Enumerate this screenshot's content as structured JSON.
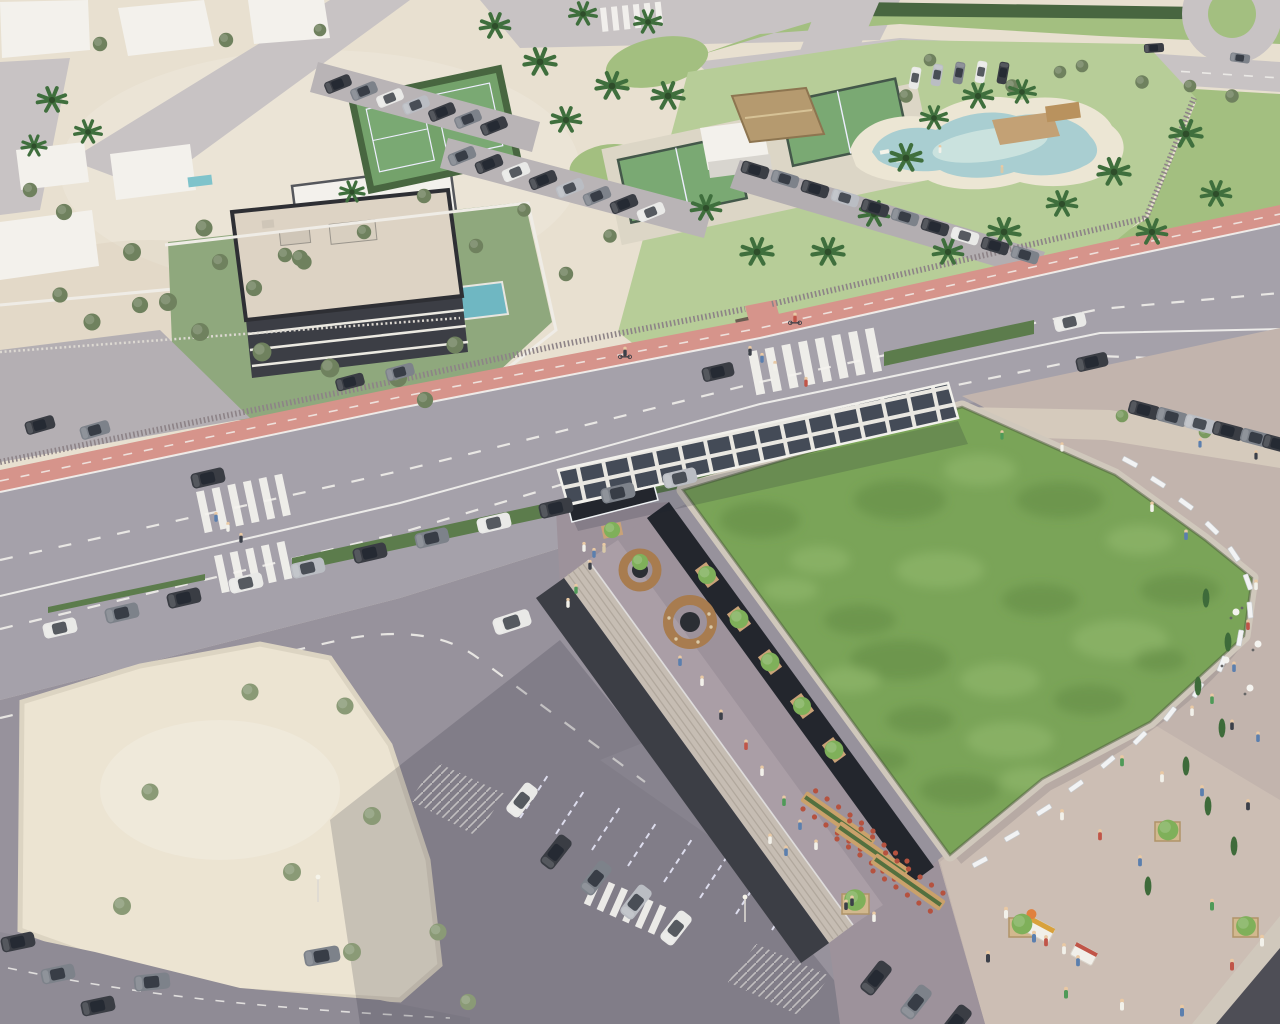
{
  "meta": {
    "title": "Aerial architectural rendering — coastal commercial building with sedum green roof, rooftop promenade, beach club and parking",
    "description": "Sunny high-angle render: a large commercial building with a mottled green roof, photovoltaic entrance canopy, restaurant terrace and curved pedestrian promenade sits beside a wide boulevard with a red bike lane; across the road are a beach club with lagoon pool and padel courts, white villas, a three-storey apartment block, lawns, a roundabout, sandy plaza and car parks."
  },
  "colors": {
    "sand": "#e8e0d0",
    "plaza": "#ece4d2",
    "roadMain": "#a5a1aa",
    "roadMinor": "#c8c3c4",
    "asphalt": "#97929c",
    "redLane": "#d6948b",
    "lineWhite": "#f4f3ef",
    "lawn": "#a3bf80",
    "clubLawn": "#b7cd98",
    "court": "#7aa973",
    "hedge": "#5c7c4c",
    "hedgeDark": "#486640",
    "olive": "#6f815e",
    "treeBright": "#7fb05a",
    "palm": "#3f6f3d",
    "cypress": "#3e6b3a",
    "water": "#a9ced1",
    "waterLight": "#d2e7e1",
    "beach": "#ece6d4",
    "deck": "#c3a175",
    "thatch": "#b59a6f",
    "white": "#f3f1ec",
    "roofSlab": "#ddd3c4",
    "facadeDark": "#3c3e45",
    "glassDark": "#23262d",
    "concrete": "#c9c1b5",
    "parapet": "#d0c8bc",
    "terrace": "#9d929b",
    "terraceLit": "#b4a8ae",
    "stairs": "#c6bdb3",
    "promenade": "#c2b4ad",
    "promenadeLit": "#d6c8bc",
    "greenRoof": "#7aa458",
    "greenRoofDark": "#5f8a42",
    "greenRoofLight": "#94ba6f",
    "solarPanel": "#444b57",
    "solarFrame": "#e9e7e1",
    "wood": "#a87c4f",
    "carDark": "#3a3d44",
    "carGray": "#7d828a",
    "carSilver": "#babdc3",
    "carWhite": "#e9e9e7",
    "chairRed": "#b5523f",
    "shadow": "#232033"
  },
  "scene": {
    "setting": "Sunny coastal resort district, high-angle aerial view, no visible text in image",
    "regions": [
      {
        "name": "beach-club",
        "label": "Beach club with lagoon pool, padel courts, thatched pavilion and palms"
      },
      {
        "name": "lagoon-pool",
        "label": "Free-form lagoon pool with sandy beach edge and timber deck"
      },
      {
        "name": "padel-courts",
        "label": "Fenced padel courts plus a hedge-enclosed multi-sport court"
      },
      {
        "name": "apartment-building",
        "label": "Three-storey apartment block, cream flat roof, glass facade, private pool"
      },
      {
        "name": "villas",
        "label": "White flat-roof villas with gardens and small pools"
      },
      {
        "name": "main-boulevard",
        "label": "Wide diagonal avenue, dashed lane lines, zebra crossings, salmon-red bike lane, slat fence"
      },
      {
        "name": "street-parking",
        "label": "Parallel parking lane screened by long hedges"
      },
      {
        "name": "commercial-building",
        "label": "Commercial building with extensive sedum green roof and dark facade"
      },
      {
        "name": "solar-canopy",
        "label": "Photovoltaic pergola over the entrance corner"
      },
      {
        "name": "roof-terrace",
        "label": "Restaurant terrace: communal tables with red chairs, round timber kiosks, planters, broad stairs"
      },
      {
        "name": "promenade",
        "label": "Curved elevated promenade with white benches, cypresses, cafe tables and food carts"
      },
      {
        "name": "plaza",
        "label": "Sandy event plaza with young trees"
      },
      {
        "name": "parking-lot",
        "label": "Asphalt car park with angled bays, hatched zones, partly in building shadow"
      },
      {
        "name": "lawn-roundabout",
        "label": "Large lawn beside curved road and a roundabout in the top-right corner"
      }
    ],
    "counts": {
      "cars": 71,
      "pedestrians": 60,
      "cyclists": 2,
      "palm_trees": 27,
      "cypress_trees": 8,
      "park_trees": 40,
      "dining_tables": 3,
      "terrace_kiosks": 2,
      "food_carts": 2,
      "padel_courts": 2,
      "zebra_crossings": 4,
      "solar_canopy_bays": 14,
      "white_benches": 17
    },
    "lighting": "Low warm sun from upper right; long soft shadows toward lower left"
  }
}
